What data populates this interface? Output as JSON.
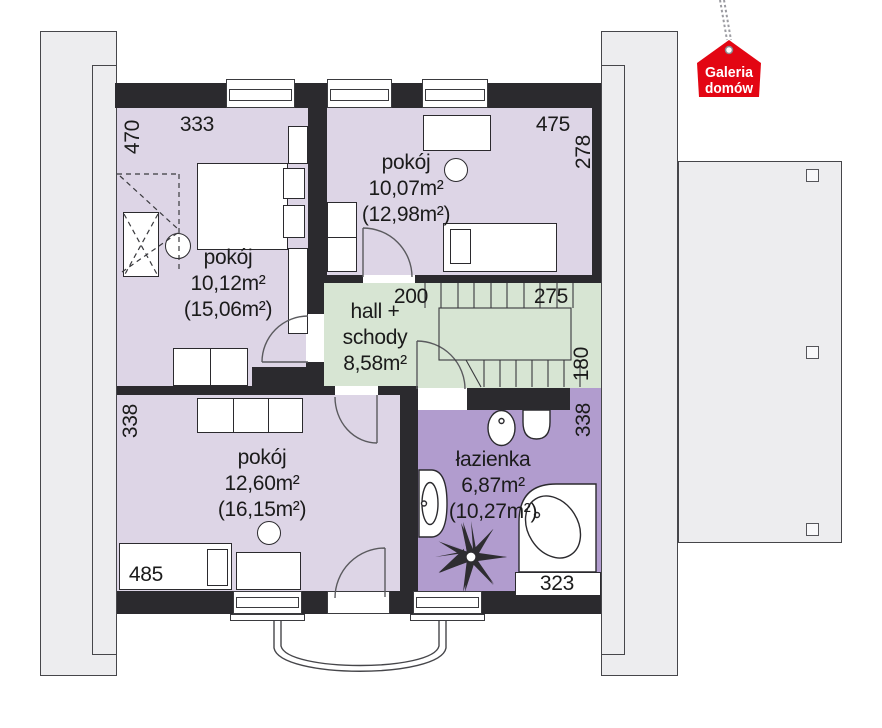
{
  "logo": {
    "line1": "Galeria",
    "line2": "domów"
  },
  "rooms": {
    "top_left": {
      "name": "pokój",
      "area": "10,12m²",
      "area_total": "(15,06m²)"
    },
    "top_right": {
      "name": "pokój",
      "area": "10,07m²",
      "area_total": "(12,98m²)"
    },
    "hall": {
      "line1": "hall +",
      "line2": "schody",
      "area": "8,58m²"
    },
    "bottom_left": {
      "name": "pokój",
      "area": "12,60m²",
      "area_total": "(16,15m²)"
    },
    "bathroom": {
      "name": "łazienka",
      "area": "6,87m²",
      "area_total": "(10,27m²)"
    }
  },
  "dimensions": {
    "top_left_height": "470",
    "top_left_width": "333",
    "top_right_width": "475",
    "top_right_height": "278",
    "hall_width": "200",
    "stairs_width": "275",
    "stairs_height": "180",
    "bottom_left_height": "338",
    "bathroom_height": "338",
    "bottom_left_width": "485",
    "bathroom_width": "323"
  },
  "colors": {
    "room": "#ddd5e6",
    "hall": "#d7e5d3",
    "bathroom": "#b19cce",
    "wall": "#2b2a2e",
    "roof": "#ededef",
    "logo_red": "#e30613"
  }
}
